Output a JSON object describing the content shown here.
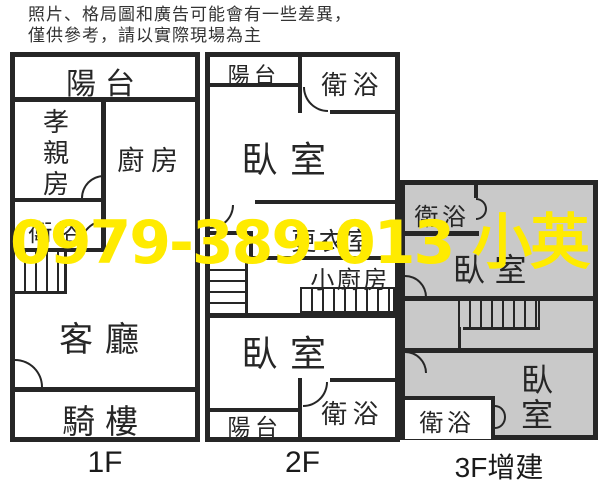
{
  "disclaimer": {
    "line1": "照片、格局圖和廣告可能會有一些差異，",
    "line2": "僅供參考，請以實際現場為主"
  },
  "watermark": {
    "text": "0979-389-013 小英",
    "color": "#ffeb00"
  },
  "floor1": {
    "label": "1F",
    "balcony": "陽台",
    "parents_room": "孝親房",
    "kitchen": "廚房",
    "bathroom": "衛浴",
    "living_room": "客廳",
    "arcade": "騎樓"
  },
  "floor2": {
    "label": "2F",
    "balcony_top": "陽台",
    "bathroom_top": "衛浴",
    "bedroom_upper": "臥室",
    "dressing_room": "更衣室",
    "small_kitchen": "小廚房",
    "bedroom_lower": "臥室",
    "bathroom_bottom": "衛浴",
    "balcony_bottom": "陽台"
  },
  "floor3": {
    "label": "3F增建",
    "bathroom_top": "衛浴",
    "bedroom_upper": "臥室",
    "bathroom_bottom": "衛浴",
    "bedroom_lower": "臥室"
  },
  "colors": {
    "wall": "#262626",
    "floor3_fill": "#c9c9c9",
    "watermark_yellow": "#ffeb00"
  }
}
